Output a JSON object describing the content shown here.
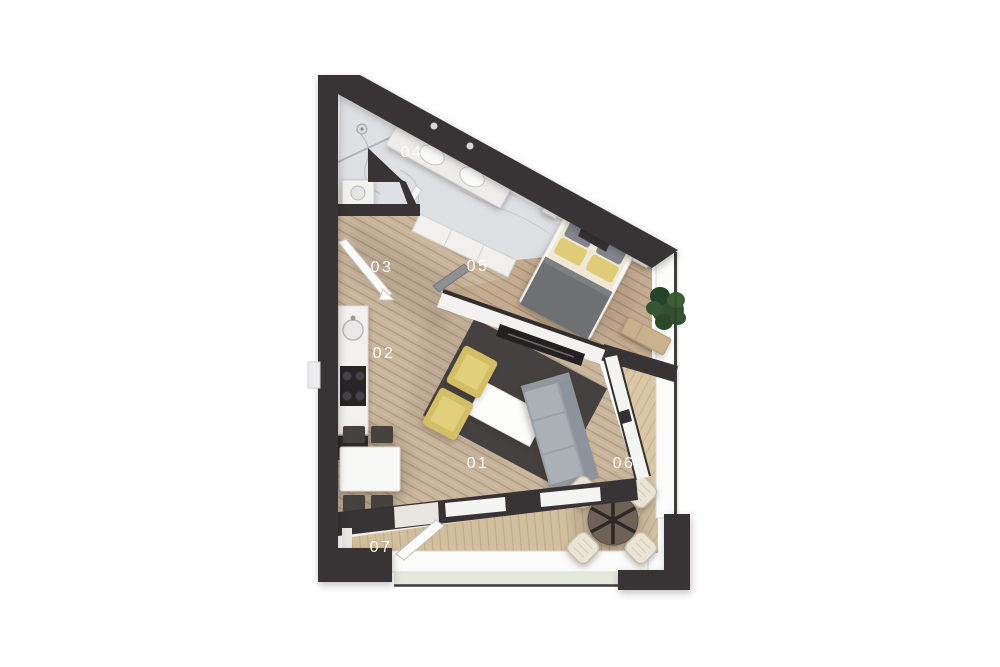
{
  "plan": {
    "kind": "apartment-floor-plan-3d-top-view",
    "rooms": [
      {
        "id": "01",
        "name": "living room"
      },
      {
        "id": "02",
        "name": "kitchen"
      },
      {
        "id": "03",
        "name": "hallway"
      },
      {
        "id": "04",
        "name": "bathroom"
      },
      {
        "id": "05",
        "name": "bedroom"
      },
      {
        "id": "06",
        "name": "terrace"
      },
      {
        "id": "07",
        "name": "balcony"
      }
    ],
    "colors": {
      "wall": "#383334",
      "floor_wood": "#c9b49c",
      "floor_bedroom": "#c3ab90",
      "floor_terrace": "#d9c7a6",
      "floor_marble": "#dfe0e4",
      "armchair_accent": "#d3bd66",
      "sofa": "#9ba1a7",
      "bed_blanket": "#6e7074",
      "label_text": "#ffffff"
    }
  }
}
